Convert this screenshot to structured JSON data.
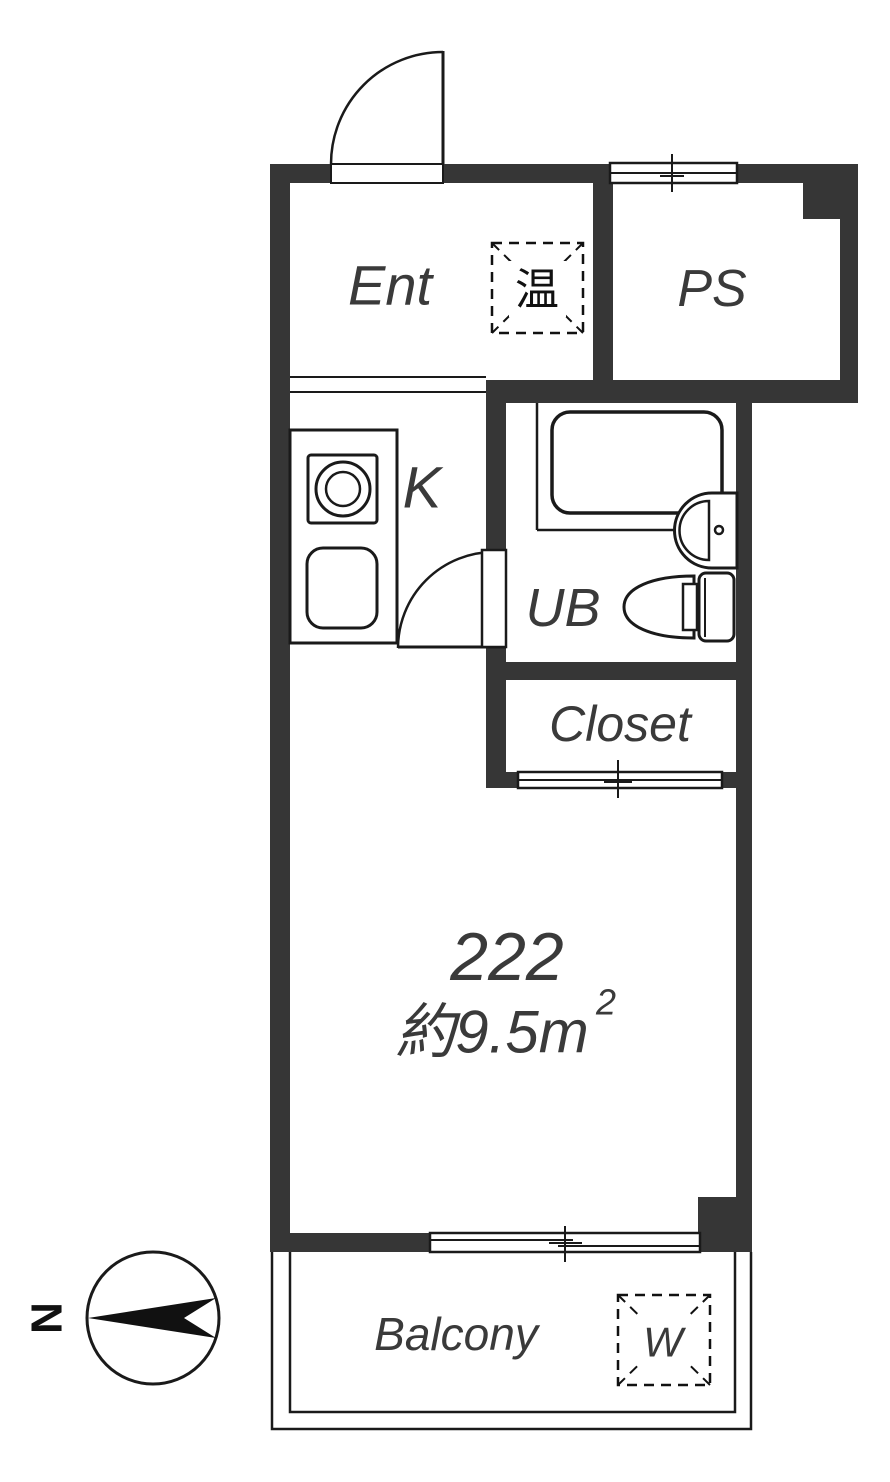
{
  "title": "Floor plan unit 222",
  "colors": {
    "wall": "#363636",
    "line": "#1a1a1a",
    "label": "#3a3a3a",
    "background": "#ffffff"
  },
  "rooms": {
    "entrance": {
      "label": "Ent"
    },
    "pipe_space": {
      "label": "PS"
    },
    "kitchen": {
      "label": "K"
    },
    "unit_bath": {
      "label": "UB"
    },
    "closet": {
      "label": "Closet"
    },
    "main_room": {
      "unit_number": "222",
      "area_label": "約9.5m",
      "area_superscript": "2"
    },
    "balcony": {
      "label": "Balcony"
    }
  },
  "symbols": {
    "water_heater": {
      "label": "温"
    },
    "washing_machine": {
      "label": "W"
    },
    "compass": {
      "label": "N"
    }
  }
}
